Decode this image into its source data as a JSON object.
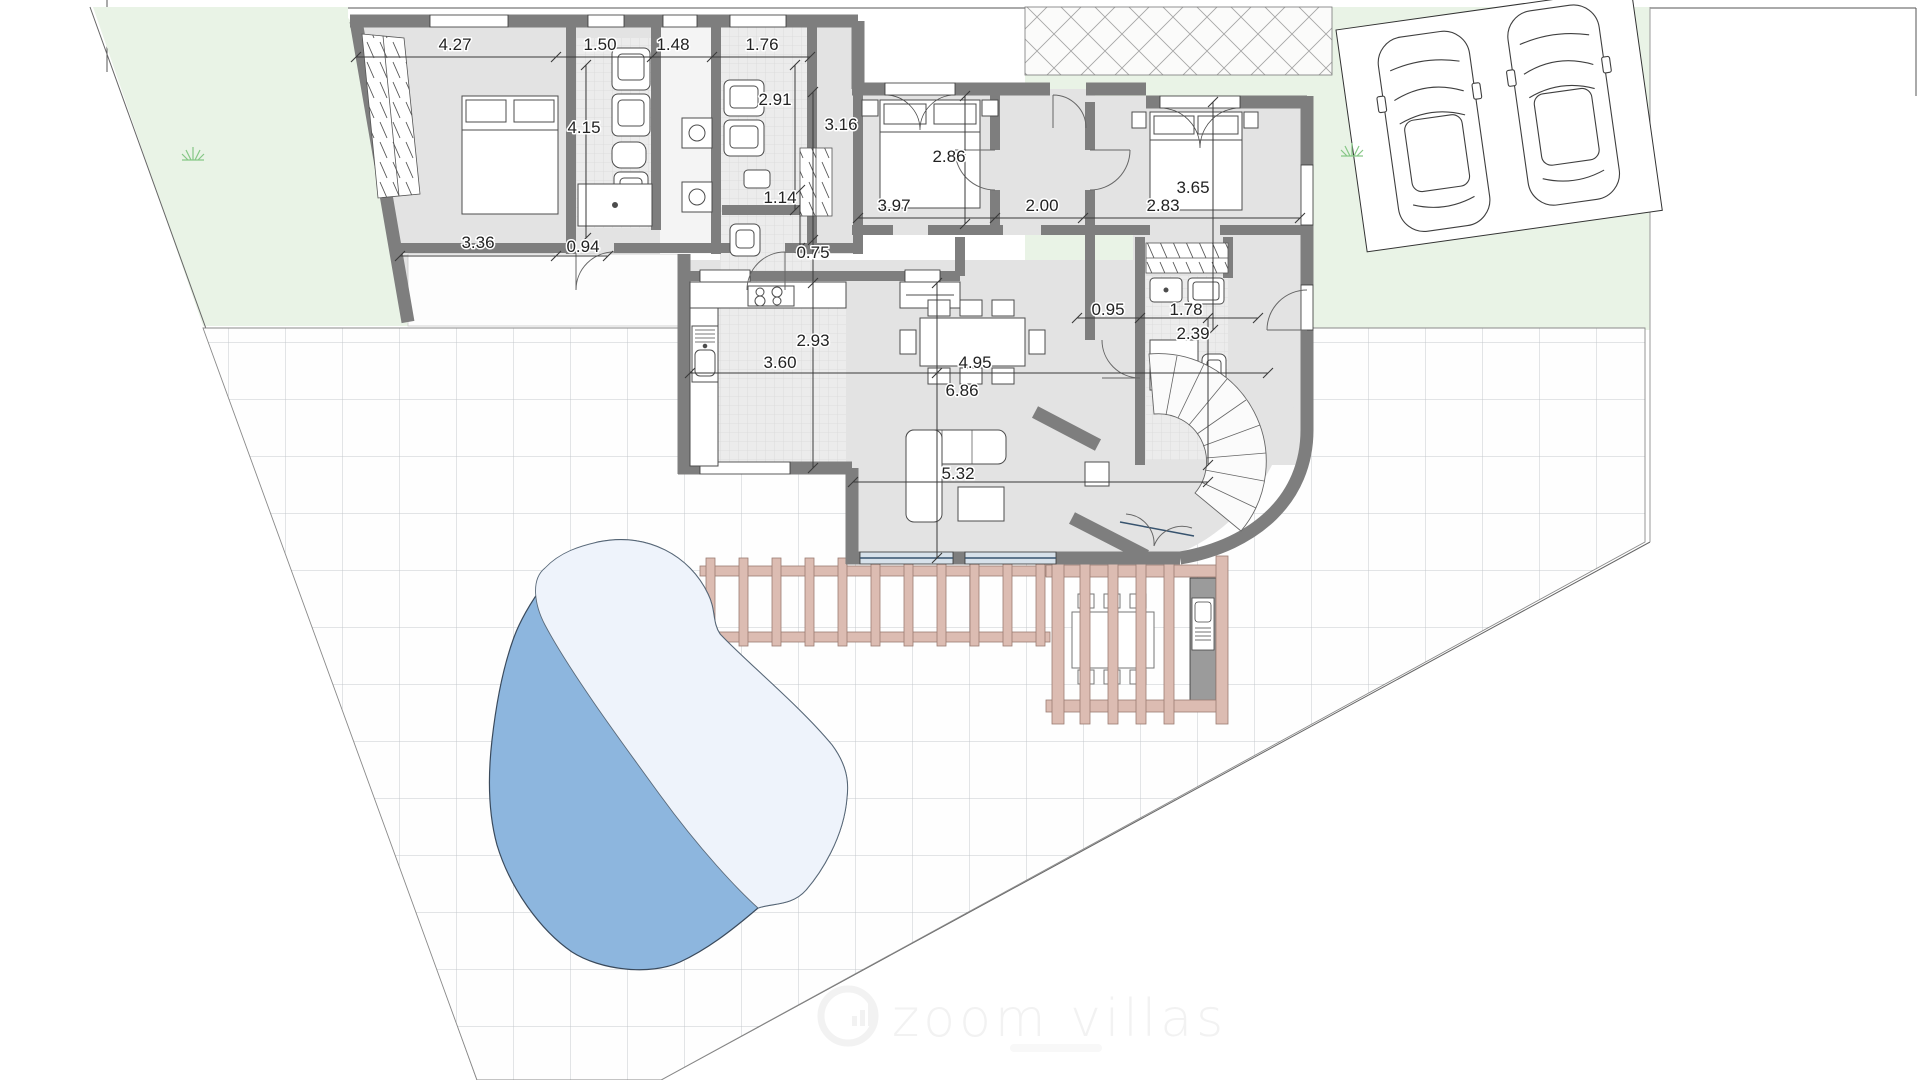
{
  "plan": {
    "type": "villa-ground-floor-site-plan",
    "watermark": {
      "text": "zoom villas",
      "logo": "zoom-villas-logo"
    },
    "dims": {
      "bedroom1_top": "4.27",
      "bathroom1_top": "1.50",
      "laundry_top": "1.48",
      "bathroom2_top": "1.76",
      "bathroom2_depth": "2.91",
      "hallway_depth": "3.16",
      "bedroom2_depth": "2.86",
      "bathroom1_depth": "4.15",
      "wc_depth": "1.14",
      "bedroom2_width": "3.97",
      "hall_width": "2.00",
      "bedroom3_depth": "3.65",
      "bedroom3_width": "2.83",
      "bedroom1_bottom": "3.36",
      "porch_opening": "0.94",
      "kitchen_offset": "0.75",
      "kitchen_depth": "2.93",
      "kitchen_width": "3.60",
      "dining_width": "4.95",
      "greatroom_depth": "6.86",
      "ensuite_offset": "0.95",
      "ensuite_width": "1.78",
      "ensuite_depth": "2.39",
      "living_width": "5.32"
    },
    "colors": {
      "wall": "#7e7e7e",
      "lawn": "#e9f3e6",
      "grid_line": "#c5c9cd",
      "pool_dark": "#8db6de",
      "pool_light": "#eef3fb",
      "pergola": "#dcbcb2",
      "glazing": "#d7e1ea"
    }
  }
}
